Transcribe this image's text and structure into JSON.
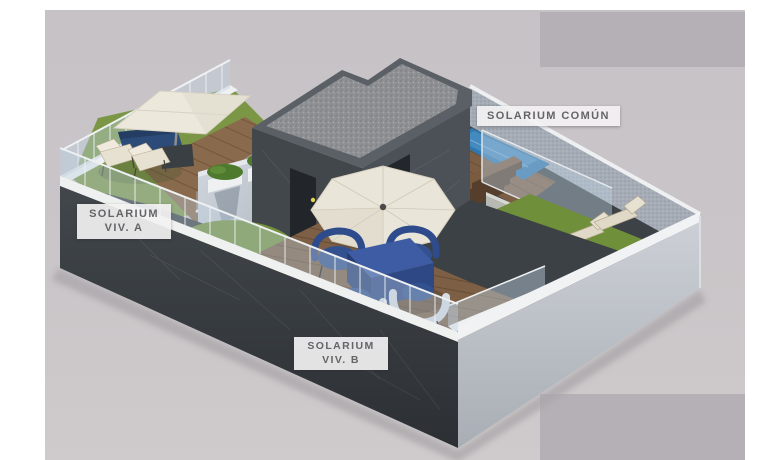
{
  "labels": {
    "solarium_a": {
      "line1": "SOLARIUM",
      "line2": "VIV. A"
    },
    "solarium_b": {
      "line1": "SOLARIUM",
      "line2": "VIV. B"
    },
    "solarium_comun": {
      "text": "SOLARIUM COMÚN"
    }
  },
  "scene": {
    "type": "3d-architectural-render",
    "subject": "Rooftop solarium plan with private terraces and shared pool area",
    "areas": [
      {
        "id": "solarium-a",
        "description": "private terrace with umbrella, loungers and sofa"
      },
      {
        "id": "solarium-b",
        "description": "private terrace with umbrella, dining table and four chairs"
      },
      {
        "id": "solarium-comun",
        "description": "shared area with pool, wooden steps and sun loungers"
      }
    ],
    "colors": {
      "page_background": "#ffffff",
      "render_background": "#c8c4c8",
      "masked_block": "#b4b0b5",
      "dark_wall": "#3a3f43",
      "light_wall": "#c3c8ce",
      "white_rail": "#f0f1f2",
      "wood_deck": "#7d5f45",
      "grass": "#73913c",
      "pool_water": "#2f77ae",
      "umbrella": "#eae6da",
      "blue_furniture": "#35549a",
      "gravel_roof": "#8f9194",
      "label_text": "#646467"
    }
  }
}
